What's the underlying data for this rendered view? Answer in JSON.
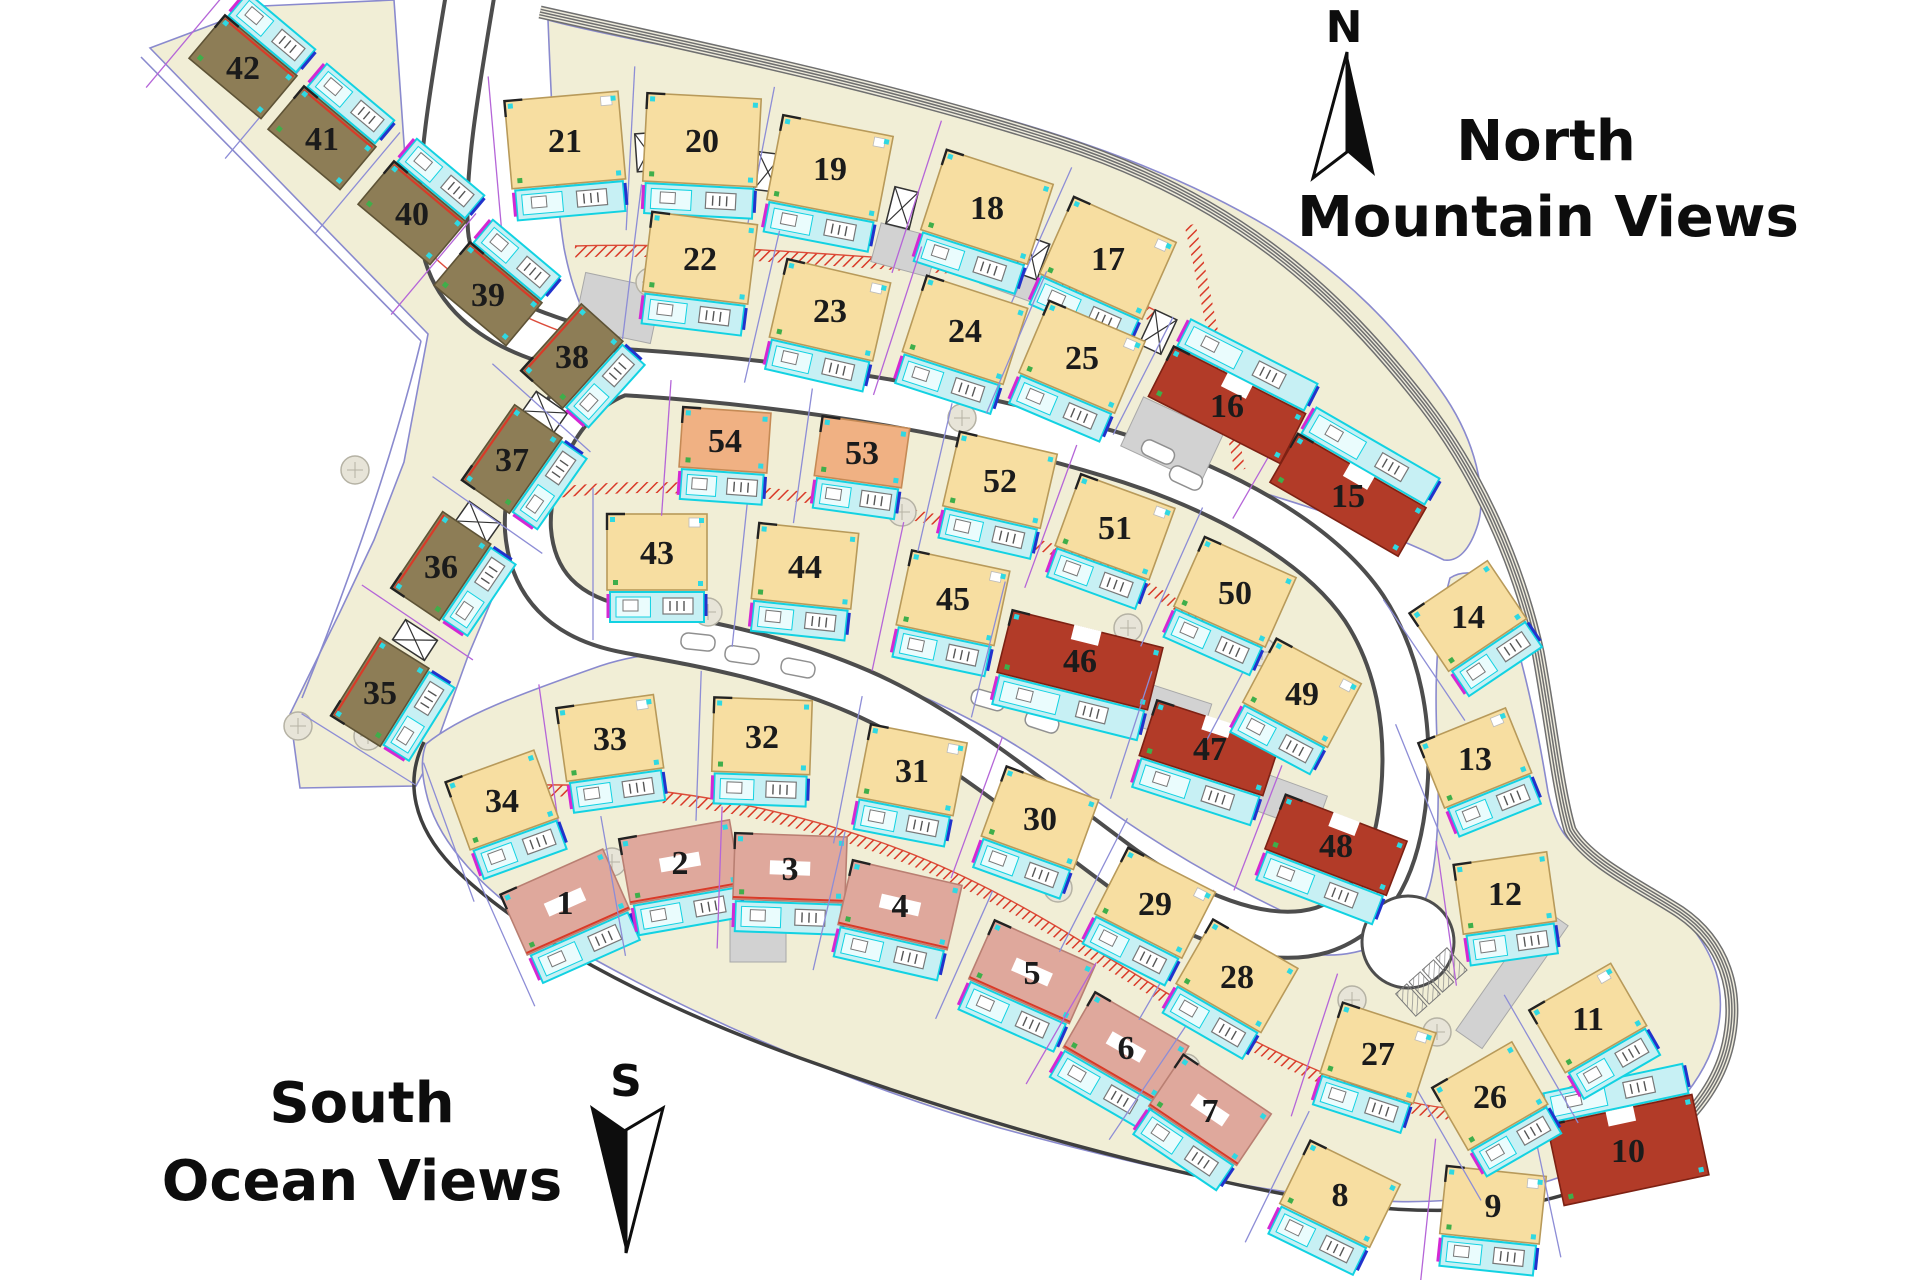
{
  "labels": {
    "region_north_line1": "North",
    "region_north_line2": "Mountain Views",
    "region_south_line1": "South",
    "region_south_line2": "Ocean Views",
    "compass_north": "N",
    "compass_south": "S"
  },
  "colors": {
    "building_yellow": "#f7dea1",
    "building_red": "#b23b28",
    "building_pink": "#dfa89c",
    "building_olive": "#8d7d56",
    "building_salmon": "#f0b183",
    "deck_fill": "#c7f0f4",
    "deck_stroke": "#12d2e2",
    "parcel_fill": "#f1eed6",
    "parcel_stroke": "#8a8ace",
    "road_casing": "#4d4d4d",
    "hatch_red": "#d93a28",
    "label_ink": "#1b1b1b"
  },
  "lots": [
    {
      "n": 1,
      "x": 565,
      "y": 902,
      "r": -24,
      "w": 112,
      "h": 66,
      "c": "pink"
    },
    {
      "n": 2,
      "x": 680,
      "y": 862,
      "r": -10,
      "w": 112,
      "h": 66,
      "c": "pink"
    },
    {
      "n": 3,
      "x": 790,
      "y": 868,
      "r": 2,
      "w": 112,
      "h": 66,
      "c": "pink"
    },
    {
      "n": 4,
      "x": 900,
      "y": 905,
      "r": 13,
      "w": 112,
      "h": 66,
      "c": "pink"
    },
    {
      "n": 5,
      "x": 1032,
      "y": 972,
      "r": 24,
      "w": 110,
      "h": 64,
      "c": "pink"
    },
    {
      "n": 6,
      "x": 1126,
      "y": 1047,
      "r": 30,
      "w": 108,
      "h": 64,
      "c": "pink"
    },
    {
      "n": 7,
      "x": 1210,
      "y": 1110,
      "r": 34,
      "w": 106,
      "h": 62,
      "c": "pink"
    },
    {
      "n": 8,
      "x": 1340,
      "y": 1194,
      "r": 26,
      "w": 100,
      "h": 70,
      "c": "yellow"
    },
    {
      "n": 9,
      "x": 1493,
      "y": 1205,
      "r": 6,
      "w": 100,
      "h": 68,
      "c": "yellow"
    },
    {
      "n": 10,
      "x": 1628,
      "y": 1150,
      "r": -12,
      "w": 148,
      "h": 82,
      "c": "red",
      "ds": -1
    },
    {
      "n": 11,
      "x": 1588,
      "y": 1018,
      "r": -30,
      "w": 94,
      "h": 72,
      "c": "yellow"
    },
    {
      "n": 12,
      "x": 1505,
      "y": 893,
      "r": -8,
      "w": 94,
      "h": 70,
      "c": "yellow"
    },
    {
      "n": 13,
      "x": 1475,
      "y": 758,
      "r": -22,
      "w": 94,
      "h": 70,
      "c": "yellow"
    },
    {
      "n": 14,
      "x": 1468,
      "y": 616,
      "r": -34,
      "w": 94,
      "h": 70,
      "c": "yellow"
    },
    {
      "n": 15,
      "x": 1348,
      "y": 495,
      "r": 30,
      "w": 148,
      "h": 56,
      "c": "red",
      "ds": -1
    },
    {
      "n": 16,
      "x": 1227,
      "y": 405,
      "r": 27,
      "w": 148,
      "h": 56,
      "c": "red",
      "ds": -1
    },
    {
      "n": 17,
      "x": 1108,
      "y": 258,
      "r": 24,
      "w": 112,
      "h": 84,
      "c": "yellow"
    },
    {
      "n": 18,
      "x": 987,
      "y": 207,
      "r": 18,
      "w": 112,
      "h": 84,
      "c": "yellow"
    },
    {
      "n": 19,
      "x": 830,
      "y": 168,
      "r": 11,
      "w": 112,
      "h": 86,
      "c": "yellow"
    },
    {
      "n": 20,
      "x": 702,
      "y": 140,
      "r": 3,
      "w": 114,
      "h": 88,
      "c": "yellow"
    },
    {
      "n": 21,
      "x": 565,
      "y": 140,
      "r": -5,
      "w": 114,
      "h": 88,
      "c": "yellow"
    },
    {
      "n": 22,
      "x": 700,
      "y": 258,
      "r": 7,
      "w": 106,
      "h": 80,
      "c": "yellow"
    },
    {
      "n": 23,
      "x": 830,
      "y": 310,
      "r": 13,
      "w": 106,
      "h": 80,
      "c": "yellow"
    },
    {
      "n": 24,
      "x": 965,
      "y": 330,
      "r": 18,
      "w": 106,
      "h": 80,
      "c": "yellow"
    },
    {
      "n": 25,
      "x": 1082,
      "y": 357,
      "r": 23,
      "w": 104,
      "h": 78,
      "c": "yellow"
    },
    {
      "n": 26,
      "x": 1490,
      "y": 1096,
      "r": -30,
      "w": 92,
      "h": 72,
      "c": "yellow"
    },
    {
      "n": 27,
      "x": 1378,
      "y": 1053,
      "r": 18,
      "w": 98,
      "h": 74,
      "c": "yellow"
    },
    {
      "n": 28,
      "x": 1237,
      "y": 976,
      "r": 30,
      "w": 98,
      "h": 74,
      "c": "yellow"
    },
    {
      "n": 29,
      "x": 1155,
      "y": 903,
      "r": 27,
      "w": 98,
      "h": 74,
      "c": "yellow"
    },
    {
      "n": 30,
      "x": 1040,
      "y": 818,
      "r": 20,
      "w": 98,
      "h": 74,
      "c": "yellow"
    },
    {
      "n": 31,
      "x": 912,
      "y": 770,
      "r": 11,
      "w": 98,
      "h": 74,
      "c": "yellow"
    },
    {
      "n": 32,
      "x": 762,
      "y": 736,
      "r": 2,
      "w": 98,
      "h": 74,
      "c": "yellow"
    },
    {
      "n": 33,
      "x": 610,
      "y": 738,
      "r": -8,
      "w": 98,
      "h": 74,
      "c": "yellow"
    },
    {
      "n": 34,
      "x": 502,
      "y": 800,
      "r": -20,
      "w": 94,
      "h": 72,
      "c": "yellow"
    },
    {
      "n": 35,
      "x": 380,
      "y": 692,
      "r": -58,
      "w": 92,
      "h": 58,
      "c": "olive"
    },
    {
      "n": 36,
      "x": 441,
      "y": 566,
      "r": -56,
      "w": 92,
      "h": 58,
      "c": "olive"
    },
    {
      "n": 37,
      "x": 512,
      "y": 459,
      "r": -55,
      "w": 92,
      "h": 58,
      "c": "olive"
    },
    {
      "n": 38,
      "x": 572,
      "y": 356,
      "r": -48,
      "w": 90,
      "h": 56,
      "c": "olive"
    },
    {
      "n": 39,
      "x": 488,
      "y": 294,
      "r": 40,
      "w": 94,
      "h": 56,
      "c": "olive",
      "ds": -1
    },
    {
      "n": 40,
      "x": 412,
      "y": 213,
      "r": 40,
      "w": 94,
      "h": 56,
      "c": "olive",
      "ds": -1
    },
    {
      "n": 41,
      "x": 322,
      "y": 138,
      "r": 40,
      "w": 94,
      "h": 56,
      "c": "olive",
      "ds": -1
    },
    {
      "n": 42,
      "x": 243,
      "y": 67,
      "r": 40,
      "w": 94,
      "h": 56,
      "c": "olive",
      "ds": -1
    },
    {
      "n": 43,
      "x": 657,
      "y": 552,
      "r": 0,
      "w": 100,
      "h": 76,
      "c": "yellow"
    },
    {
      "n": 44,
      "x": 805,
      "y": 566,
      "r": 6,
      "w": 100,
      "h": 76,
      "c": "yellow"
    },
    {
      "n": 45,
      "x": 953,
      "y": 598,
      "r": 12,
      "w": 100,
      "h": 76,
      "c": "yellow"
    },
    {
      "n": 46,
      "x": 1080,
      "y": 660,
      "r": 14,
      "w": 155,
      "h": 64,
      "c": "red"
    },
    {
      "n": 47,
      "x": 1210,
      "y": 748,
      "r": 18,
      "w": 130,
      "h": 58,
      "c": "red"
    },
    {
      "n": 48,
      "x": 1336,
      "y": 845,
      "r": 21,
      "w": 130,
      "h": 58,
      "c": "red"
    },
    {
      "n": 49,
      "x": 1302,
      "y": 693,
      "r": 28,
      "w": 96,
      "h": 72,
      "c": "yellow"
    },
    {
      "n": 50,
      "x": 1235,
      "y": 592,
      "r": 24,
      "w": 100,
      "h": 76,
      "c": "yellow"
    },
    {
      "n": 51,
      "x": 1115,
      "y": 527,
      "r": 20,
      "w": 100,
      "h": 76,
      "c": "yellow"
    },
    {
      "n": 52,
      "x": 1000,
      "y": 480,
      "r": 13,
      "w": 100,
      "h": 76,
      "c": "yellow"
    },
    {
      "n": 53,
      "x": 862,
      "y": 452,
      "r": 8,
      "w": 88,
      "h": 60,
      "c": "salmon"
    },
    {
      "n": 54,
      "x": 725,
      "y": 440,
      "r": 4,
      "w": 88,
      "h": 60,
      "c": "salmon"
    }
  ]
}
